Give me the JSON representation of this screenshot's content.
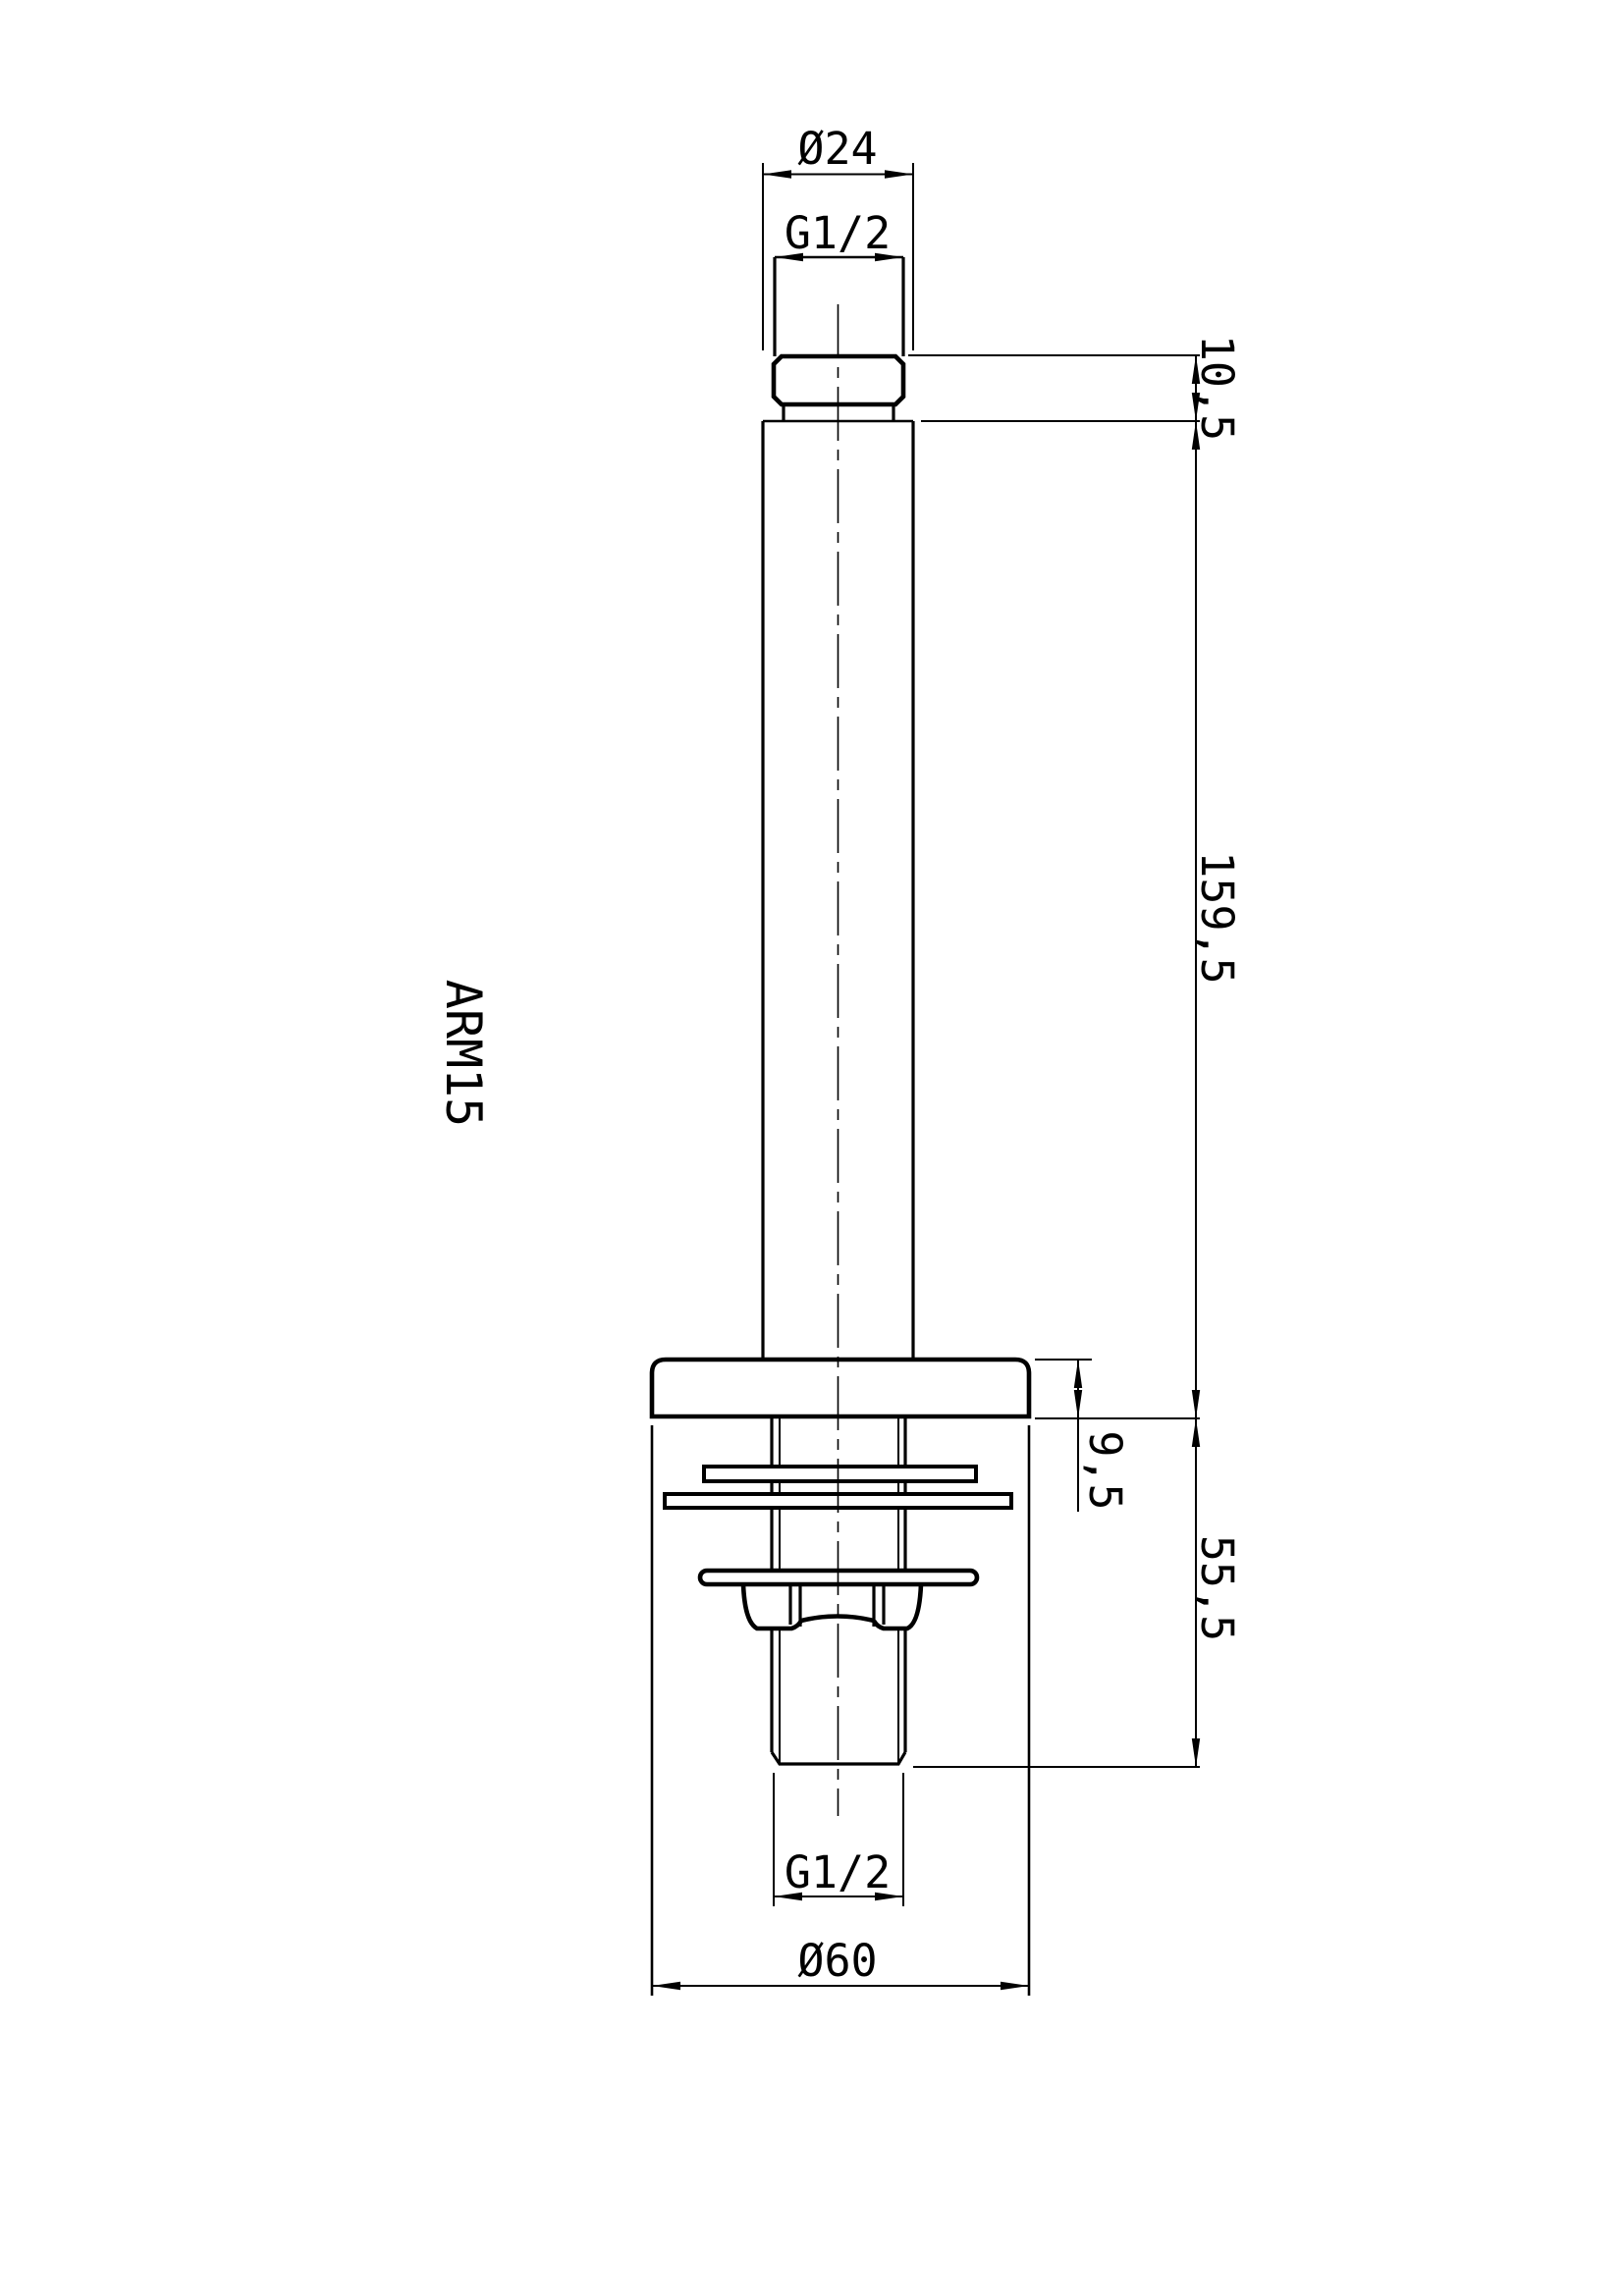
{
  "drawing": {
    "part_label": "ARM15",
    "dimensions": {
      "top_diameter": "Ø24",
      "top_thread": "G1/2",
      "head_height": "10,5",
      "arm_length": "159,5",
      "flange_thickness": "9,5",
      "lower_length": "55,5",
      "bottom_thread": "G1/2",
      "flange_diameter": "Ø60"
    },
    "colors": {
      "line": "#000000",
      "background": "#ffffff"
    }
  }
}
